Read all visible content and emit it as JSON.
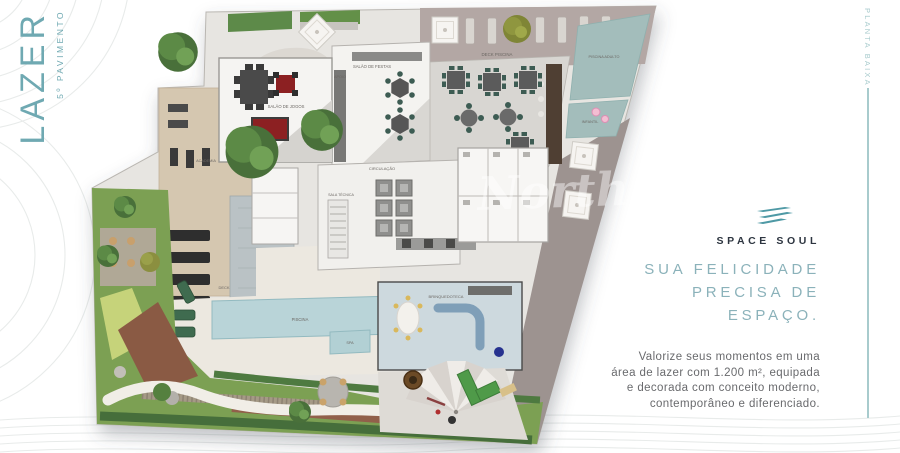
{
  "theme": {
    "accent": "#6fa9b2",
    "accent_light": "#8bb2ba",
    "accent_line": "#a8cbcd",
    "navy": "#2d3540",
    "text_gray": "#696a6d"
  },
  "left_rail": {
    "title": "LAZER",
    "subtitle": "5º PAVIMENTO"
  },
  "right_rail": {
    "vertical_label": "PLANTA BAIXA"
  },
  "brand": {
    "name": "SPACE SOUL",
    "logo_icon": "waves-icon"
  },
  "headline": {
    "line1": "SUA FELICIDADE",
    "line2": "PRECISA DE",
    "line3": "ESPAÇO."
  },
  "body_text": {
    "line1": "Valorize seus momentos em uma",
    "line2": "área de lazer com 1.200 m², equipada",
    "line3": "e decorada com conceito moderno,",
    "line4": "contemporâneo e diferenciado."
  },
  "floor_plan": {
    "watermark": "North",
    "labels": {
      "deck_piscina": "DECK PISCINA",
      "piscina_adulto": "PISCINA ADULTO",
      "piscina_infantil": "INFANTIL",
      "salao_jogos": "SALÃO DE JOGOS",
      "salao_festas": "SALÃO DE FESTAS",
      "apoio": "APOIO",
      "academia": "ACADEMIA",
      "circulacao": "CIRCULAÇÃO",
      "sala_tecnica": "SALA TÉCNICA",
      "piscina": "PISCINA",
      "spa": "SPA",
      "deck": "DECK",
      "brinquedoteca": "BRINQUEDOTECA"
    }
  }
}
